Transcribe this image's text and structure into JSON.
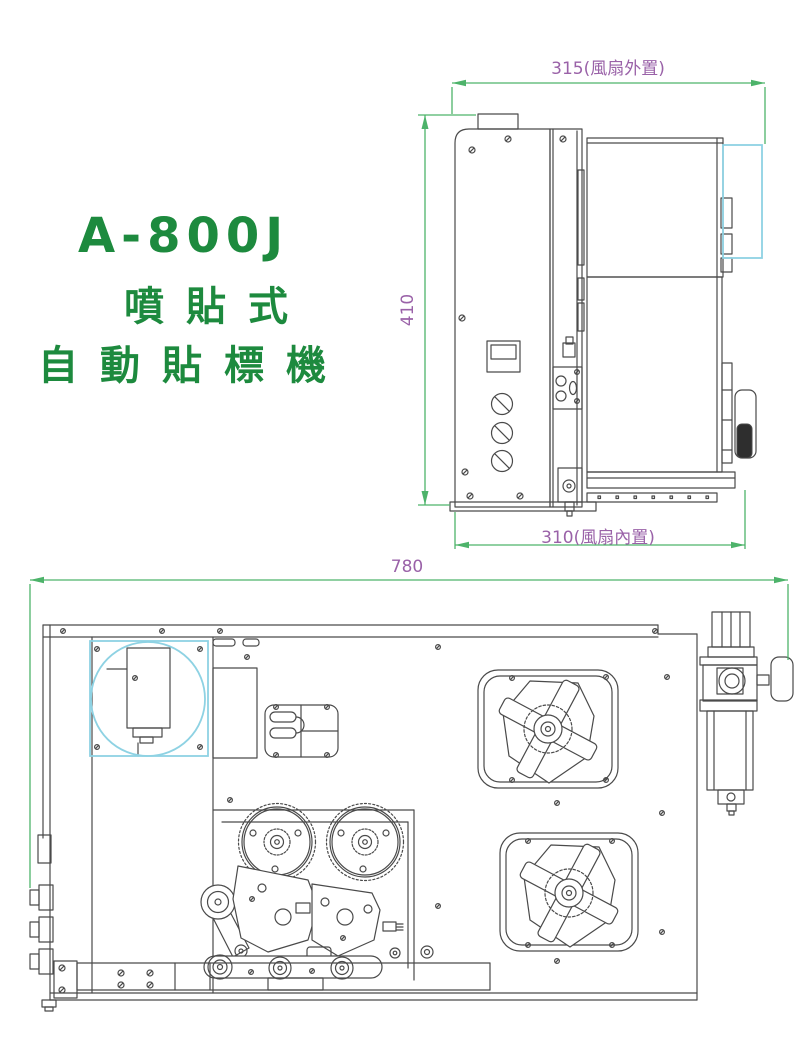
{
  "title": {
    "model": "A-800J",
    "subtitle1": "噴貼式",
    "subtitle2": "自動貼標機"
  },
  "dimensions": {
    "side_top_width": "315(風扇外置)",
    "side_height": "410",
    "side_bottom_width": "310(風扇內置)",
    "plan_width": "780"
  },
  "colors": {
    "title_green": "#1d8a3e",
    "dimension_green": "#4db36a",
    "dimension_text_purple": "#9a62a8",
    "fan_highlight_cyan": "#8ed2e3",
    "drawing_line": "#4a4a4a",
    "background": "#ffffff"
  }
}
